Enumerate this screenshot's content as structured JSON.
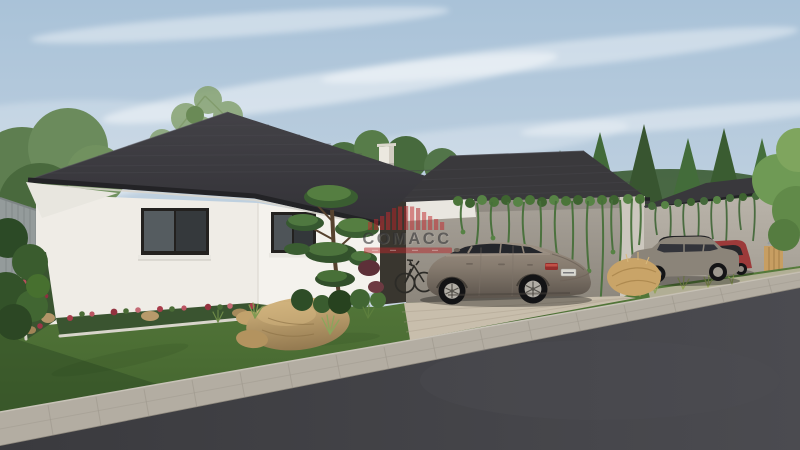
{
  "scene": {
    "type": "architectural-exterior-3d-render",
    "watermark": {
      "brand": "COMACC"
    },
    "visible_objects": [
      "white single-storey bungalow with dark hipped tile roof",
      "two dark-framed windows with white sills",
      "concrete-walled house with carport and hanging vines",
      "third house with vine-covered concrete wall and wooden gate",
      "silver-bronze sedan parked on paver driveway",
      "gray hatchback and red car parked by right house",
      "bicycle leaning at carport wall",
      "white chimney",
      "ornamental pruned pine tree",
      "flower beds with red blooms and white curb edging",
      "large tan boulders",
      "ornamental grass tufts",
      "gray slat fence",
      "green lawn",
      "paver sidewalk and dark asphalt road",
      "pine trees and leafy trees under a blue sky with wispy clouds"
    ]
  },
  "colors": {
    "sky_top": "#a9c2d8",
    "sky_horizon": "#d9e2e9",
    "roof": "#3a393c",
    "house_wall_white": "#efece6",
    "concrete_wall": "#a29c93",
    "lawn": "#4f7036",
    "road": "#3f3f43",
    "sidewalk": "#b3ada2",
    "driveway": "#c8beac",
    "bmw_body": "#857a6e",
    "hatchback_body": "#8b8479",
    "red_car": "#9c3a3a",
    "taillight": "#932e2c",
    "flowers": "#a83c4a",
    "rock": "#c0a070",
    "foliage": "#4c7042",
    "watermark_red": "#b5272c",
    "watermark_text": "#2d2d2f"
  }
}
